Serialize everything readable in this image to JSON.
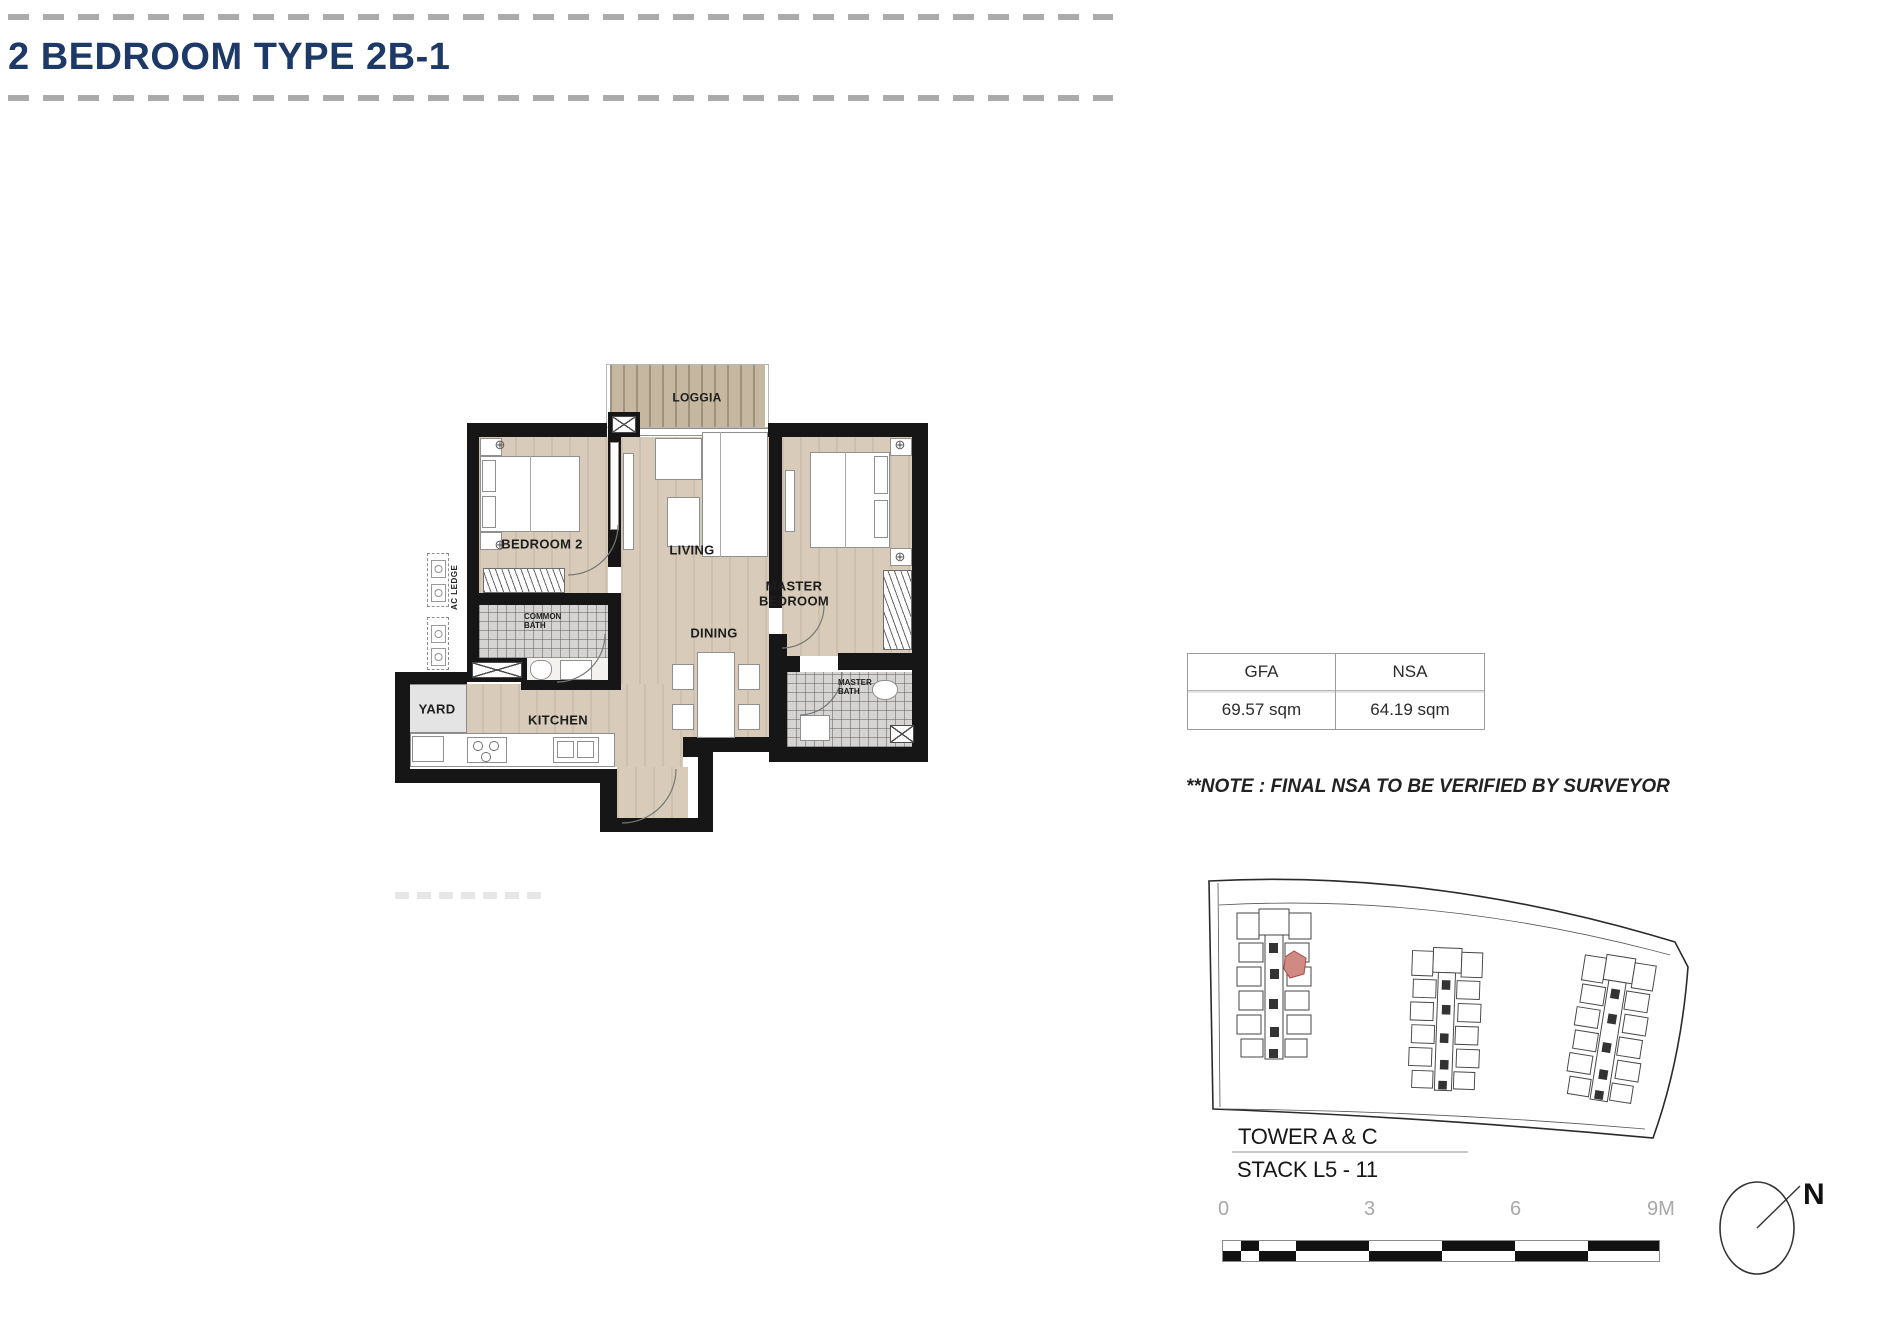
{
  "title": "2 BEDROOM TYPE 2B-1",
  "floor_plan": {
    "labels": {
      "loggia": "LOGGIA",
      "bedroom2": "BEDROOM 2",
      "living": "LIVING",
      "master_bedroom": "MASTER BEDROOM",
      "dining": "DINING",
      "kitchen": "KITCHEN",
      "yard": "YARD",
      "common_bath": "COMMON BATH",
      "master_bath": "MASTER BATH",
      "ac_ledge": "AC LEDGE"
    }
  },
  "area_table": {
    "headers": [
      "GFA",
      "NSA"
    ],
    "values": [
      "69.57 sqm",
      "64.19 sqm"
    ]
  },
  "note": "**NOTE : FINAL NSA TO BE VERIFIED BY SURVEYOR",
  "key_plan": {
    "tower_label": "TOWER A & C",
    "stack_label": "STACK L5 - 11"
  },
  "scale_bar": {
    "labels": [
      "0",
      "3",
      "6",
      "9M"
    ]
  },
  "compass": {
    "label": "N"
  },
  "colors": {
    "title_navy": "#1d3968",
    "wall_black": "#161616",
    "floor_beige": "#d8cbba",
    "loggia_tan": "#c6b7a0",
    "highlight_unit": "#d08a84"
  }
}
